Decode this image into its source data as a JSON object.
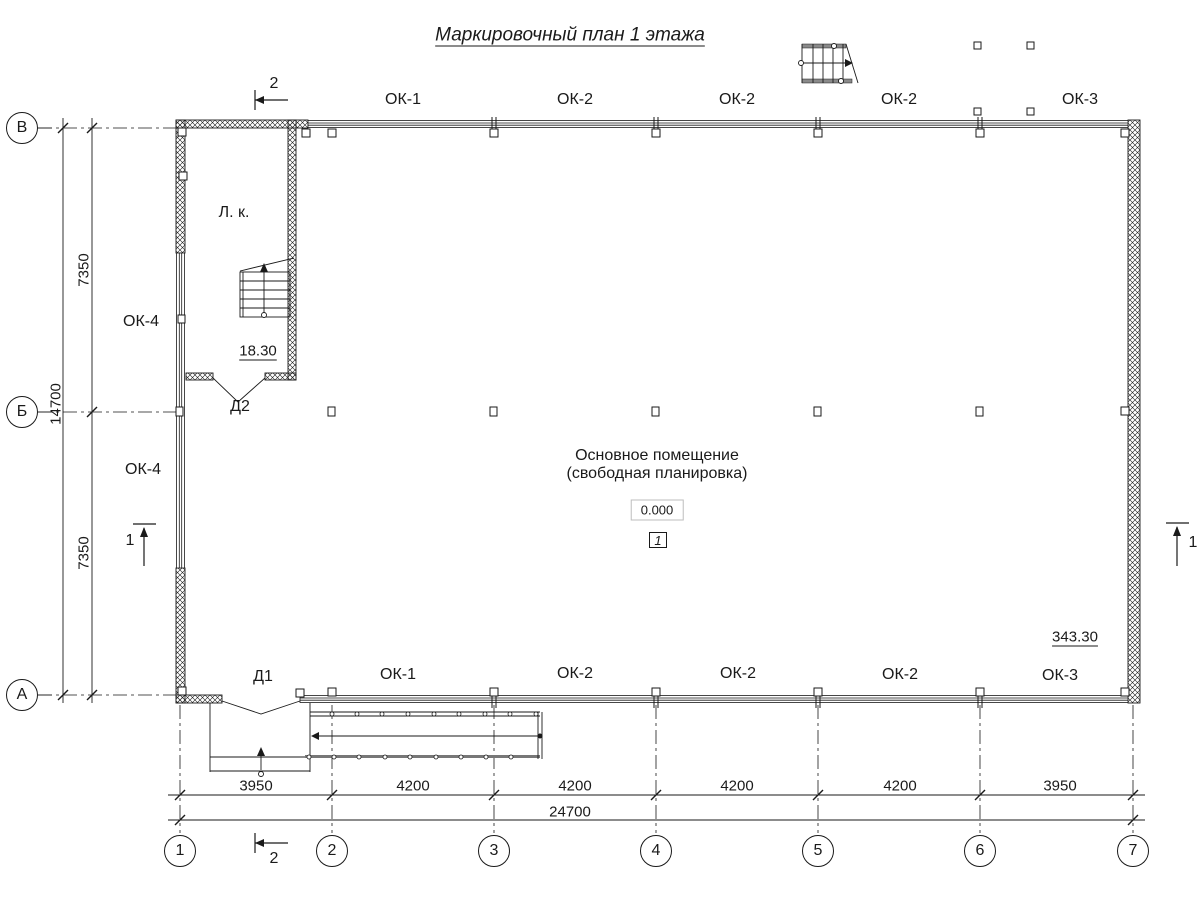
{
  "title": "Маркировочный план 1 этажа",
  "rooms": {
    "main": {
      "line1": "Основное помещение",
      "line2": "(свободная планировка)",
      "elevation": "0.000",
      "number": "1",
      "area": "343.30"
    },
    "stair": {
      "name": "Л. к.",
      "area": "18.30"
    }
  },
  "doors": {
    "d1": "Д1",
    "d2": "Д2"
  },
  "windows": {
    "top": [
      "ОК-1",
      "ОК-2",
      "ОК-2",
      "ОК-2",
      "ОК-3"
    ],
    "bottom": [
      "ОК-1",
      "ОК-2",
      "ОК-2",
      "ОК-2",
      "ОК-3"
    ],
    "left": [
      "ОК-4",
      "ОК-4"
    ]
  },
  "axes": {
    "horizontal": [
      "1",
      "2",
      "3",
      "4",
      "5",
      "6",
      "7"
    ],
    "vertical": [
      "В",
      "Б",
      "А"
    ]
  },
  "dims": {
    "bottom": [
      "3950",
      "4200",
      "4200",
      "4200",
      "4200",
      "3950"
    ],
    "bottom_total": "24700",
    "left": [
      "7350",
      "7350"
    ],
    "left_total": "14700"
  },
  "sections": {
    "s1": "1",
    "s2": "2"
  },
  "colors": {
    "line": "#1a1a1a",
    "bg": "#ffffff"
  }
}
